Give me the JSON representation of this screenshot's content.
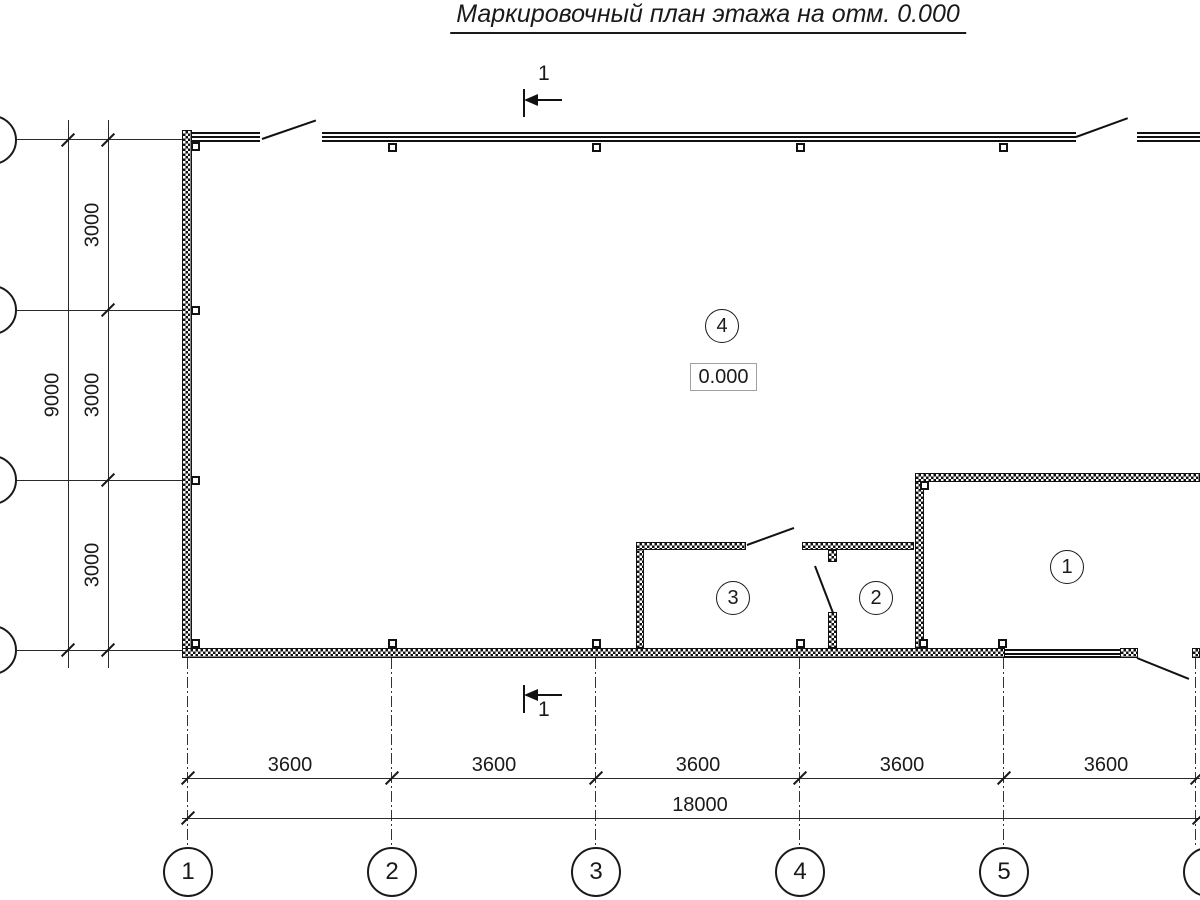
{
  "title": "Маркировочный план этажа на отм. 0.000",
  "section_marks": {
    "top_label": "1",
    "bottom_label": "1"
  },
  "room_labels": [
    "1",
    "2",
    "3",
    "4"
  ],
  "elevation": "0.000",
  "dimensions": {
    "bottom_segments": [
      "3600",
      "3600",
      "3600",
      "3600",
      "3600"
    ],
    "bottom_total": "18000",
    "left_segments": [
      "3000",
      "3000",
      "3000"
    ],
    "left_total": "9000"
  },
  "axes": {
    "columns": [
      "1",
      "2",
      "3",
      "4",
      "5",
      "6"
    ]
  },
  "colors": {
    "line": "#1a1a1a",
    "elevation_box_border": "#a0a0a0",
    "background": "#ffffff"
  }
}
